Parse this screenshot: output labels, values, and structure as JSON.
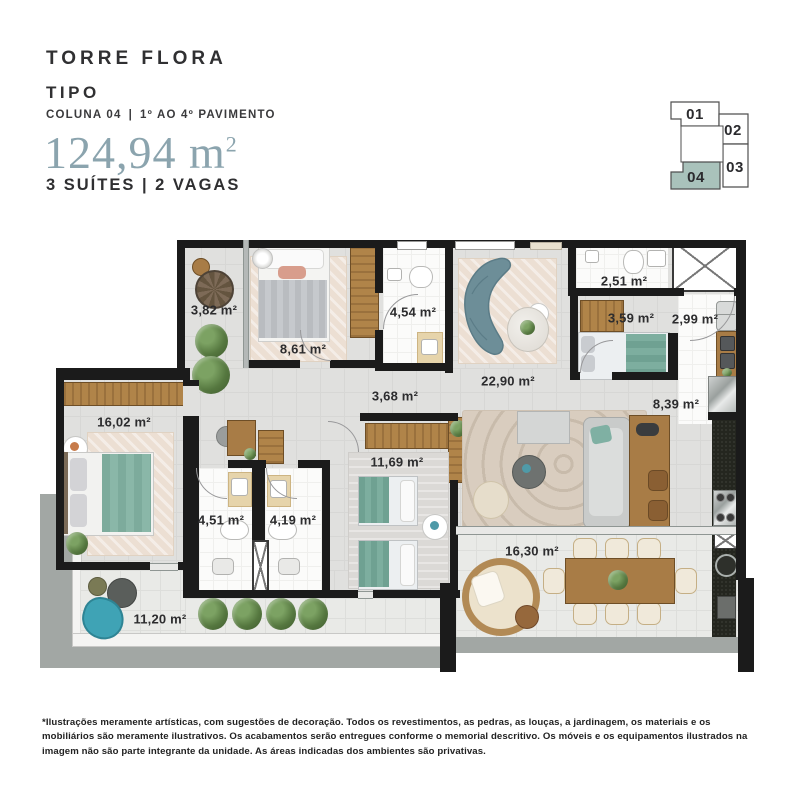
{
  "header": {
    "project_name": "TORRE FLORA",
    "plan_type": "TIPO",
    "column": "COLUNA 04",
    "divider": "|",
    "floors": "1º AO 4º PAVIMENTO",
    "total_area": "124,94 m",
    "total_area_exponent": "2",
    "features": "3 SUÍTES | 2 VAGAS"
  },
  "keyplan": {
    "highlight_color": "#a9c2bb",
    "units": [
      {
        "label": "01",
        "highlighted": false
      },
      {
        "label": "02",
        "highlighted": false
      },
      {
        "label": "03",
        "highlighted": false
      },
      {
        "label": "04",
        "highlighted": true
      }
    ]
  },
  "floorplan": {
    "rooms": [
      {
        "id": "varanda",
        "area": "3,82 m²"
      },
      {
        "id": "suite-1",
        "area": "8,61 m²"
      },
      {
        "id": "banho-suite-1",
        "area": "4,54 m²"
      },
      {
        "id": "circulacao",
        "area": "3,68 m²"
      },
      {
        "id": "estar-jantar",
        "area": "22,90 m²"
      },
      {
        "id": "banho-2",
        "area": "2,51 m²"
      },
      {
        "id": "suite-2",
        "area": "3,59 m²"
      },
      {
        "id": "hall-entrada",
        "area": "2,99 m²"
      },
      {
        "id": "cozinha",
        "area": "8,39 m²"
      },
      {
        "id": "suite-master",
        "area": "16,02 m²"
      },
      {
        "id": "banho-3",
        "area": "4,51 m²"
      },
      {
        "id": "banho-4",
        "area": "4,19 m²"
      },
      {
        "id": "dormitorio",
        "area": "11,69 m²"
      },
      {
        "id": "terraco-servico",
        "area": "11,20 m²"
      },
      {
        "id": "terraco-gourmet",
        "area": "16,30 m²"
      }
    ]
  },
  "footer": {
    "disclaimer": "*Ilustrações meramente artísticas, com sugestões de decoração. Todos os revestimentos, as pedras, as louças, a jardinagem, os materiais e os mobiliários são meramente ilustrativos. Os acabamentos serão entregues conforme o memorial descritivo. Os móveis e os equipamentos ilustrados na imagem não são parte integrante da unidade. As áreas indicadas dos ambientes são privativas."
  }
}
